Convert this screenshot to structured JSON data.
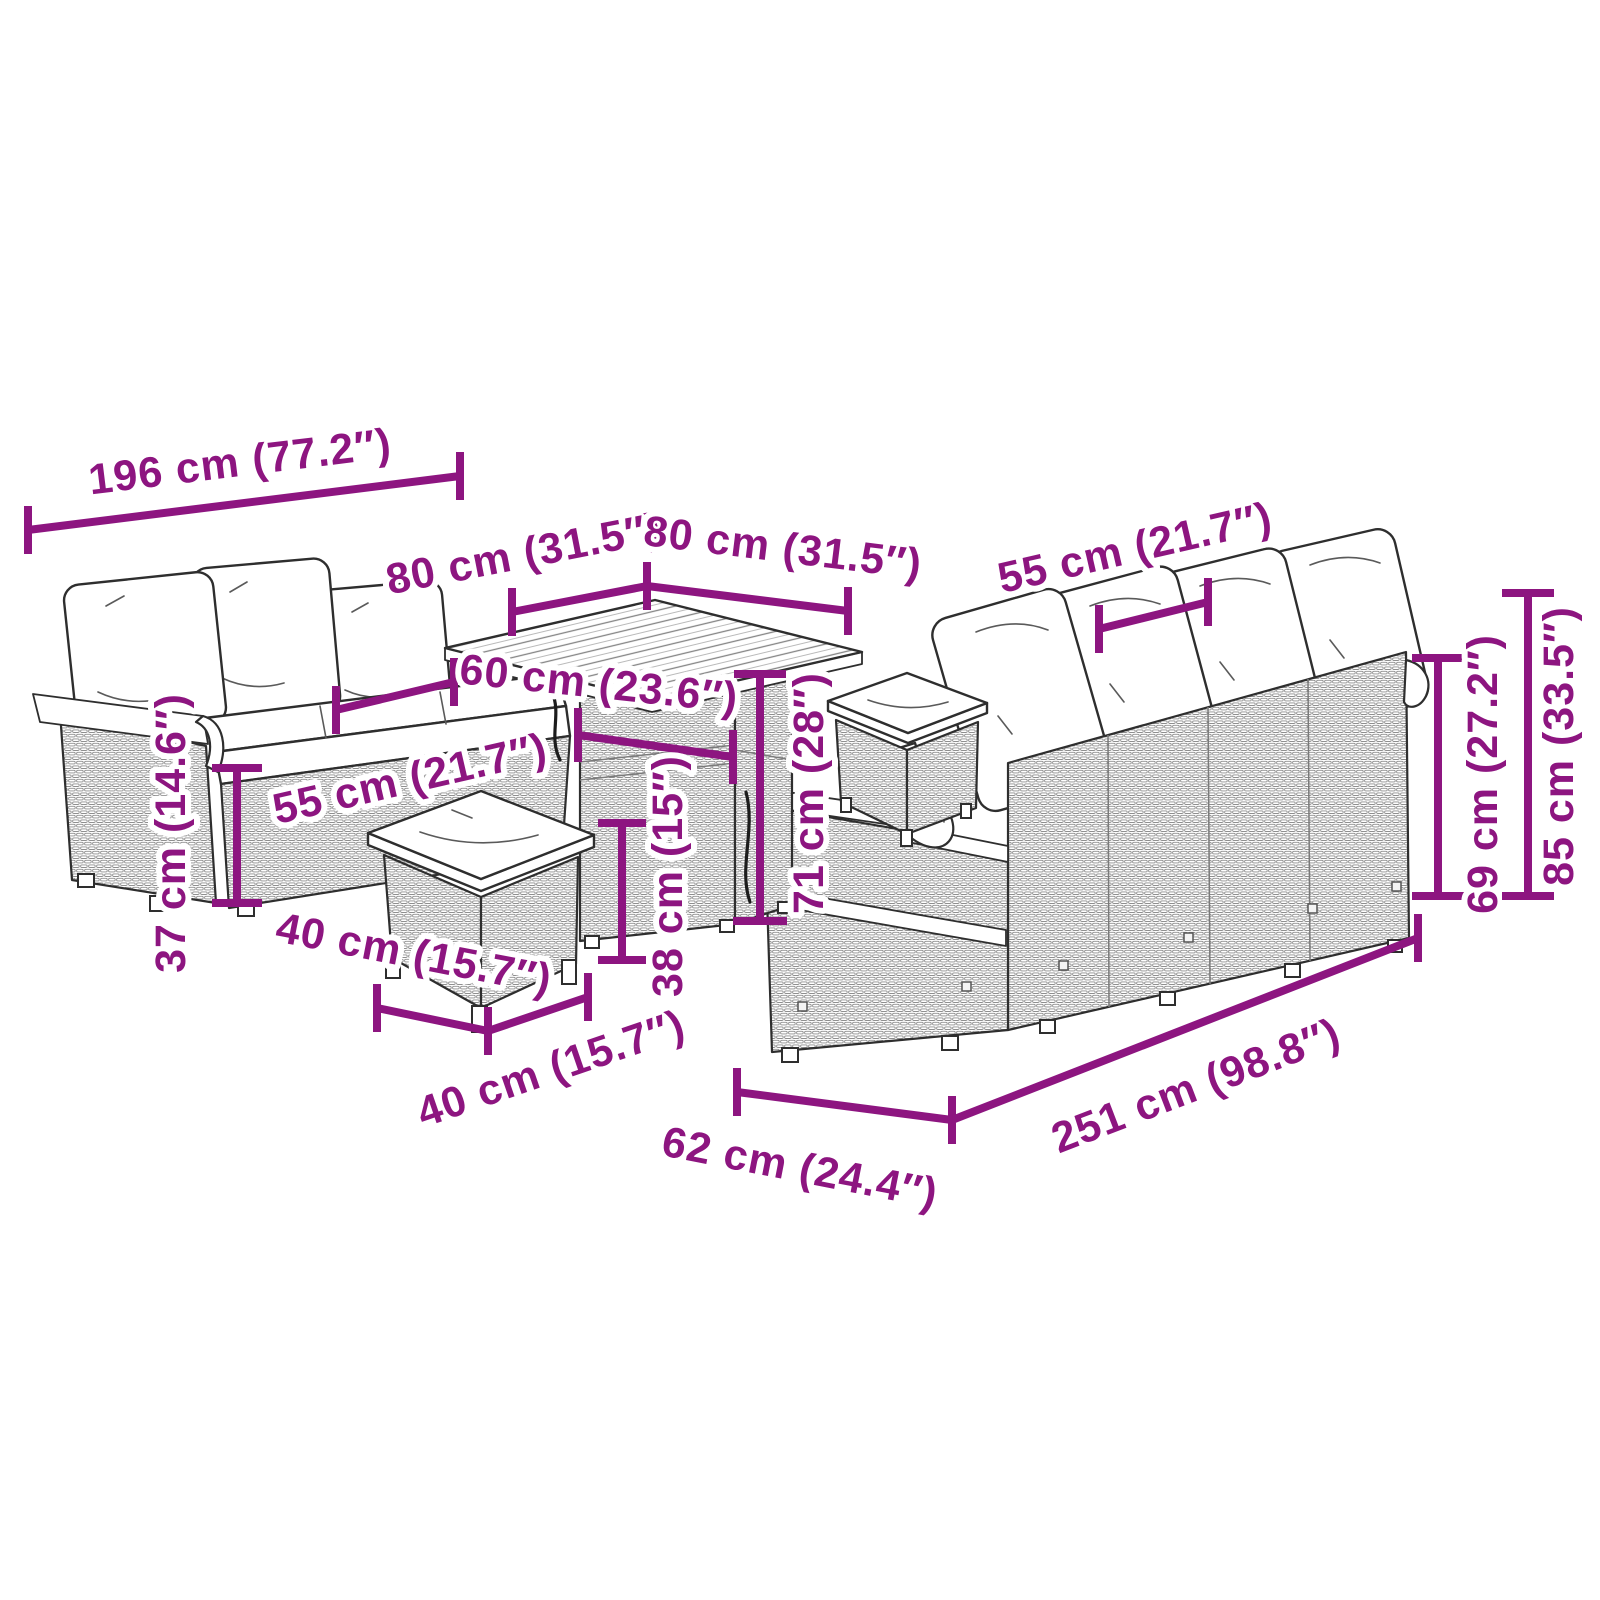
{
  "image": {
    "kind": "product-dimension-diagram",
    "product": "Poly rattan garden lounge set with cushions",
    "background": "#ffffff"
  },
  "style": {
    "dimension_color": "#8d1580",
    "outline_color": "#2e2e2e",
    "wicker_line_color": "#8f8f8f",
    "cushion_color": "#ffffff"
  },
  "pieces": [
    "three-seater sofa with back cushions",
    "square slatted-top table",
    "stool with cushion (front)",
    "stool with cushion (beside table)",
    "four-seater sofa seen from the back"
  ],
  "dimensions": {
    "sofa_left_width": {
      "label": "196 cm (77.2″)",
      "cm": 196,
      "inches": 77.2
    },
    "table_top_side_left": {
      "label": "80 cm (31.5″)",
      "cm": 80,
      "inches": 31.5
    },
    "table_top_side_right": {
      "label": "80 cm (31.5″)",
      "cm": 80,
      "inches": 31.5
    },
    "sofa_left_seat_depth": {
      "label": "55 cm (21.7″)",
      "cm": 55,
      "inches": 21.7
    },
    "table_base_width": {
      "label": "60 cm (23.6″)",
      "cm": 60,
      "inches": 23.6
    },
    "table_height": {
      "label": "71 cm (28″)",
      "cm": 71,
      "inches": 28
    },
    "sofa_left_seat_height": {
      "label": "37 cm (14.6″)",
      "cm": 37,
      "inches": 14.6
    },
    "stool_width": {
      "label": "40 cm (15.7″)",
      "cm": 40,
      "inches": 15.7
    },
    "stool_depth": {
      "label": "40 cm (15.7″)",
      "cm": 40,
      "inches": 15.7
    },
    "stool_height": {
      "label": "38 cm (15″)",
      "cm": 38,
      "inches": 15
    },
    "sofa_right_seat_depth": {
      "label": "55 cm (21.7″)",
      "cm": 55,
      "inches": 21.7
    },
    "sofa_right_back_height": {
      "label": "69 cm (27.2″)",
      "cm": 69,
      "inches": 27.2
    },
    "sofa_right_total_height": {
      "label": "85 cm (33.5″)",
      "cm": 85,
      "inches": 33.5
    },
    "sofa_right_length": {
      "label": "251 cm (98.8″)",
      "cm": 251,
      "inches": 98.8
    },
    "sofa_right_depth": {
      "label": "62 cm (24.4″)",
      "cm": 62,
      "inches": 24.4
    }
  }
}
